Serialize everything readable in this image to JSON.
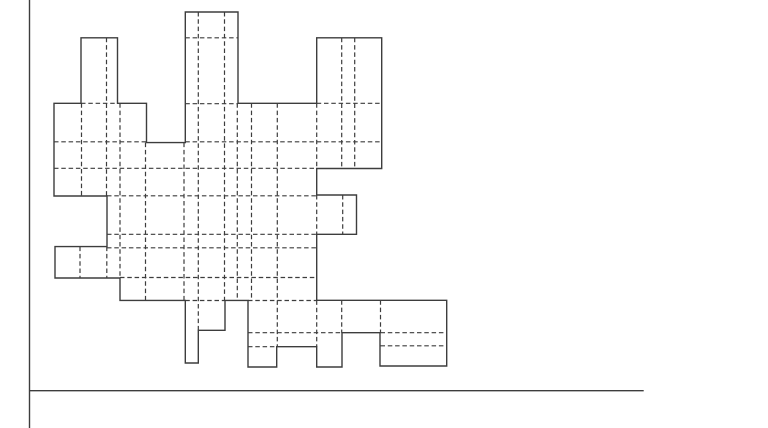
{
  "figure": {
    "canvas": {
      "width": 768,
      "height": 428,
      "background": "#ffffff"
    },
    "style": {
      "line_color": "#3d3d3d",
      "outline_width": 1.4,
      "dashed_width": 1.2,
      "spine_width": 1.4,
      "dash_pattern": "4.5 2.8"
    },
    "axes": {
      "y_spine": {
        "x": 29.5,
        "y1": 0,
        "y2": 428
      },
      "x_spine": {
        "y": 390.7,
        "x1": 29.5,
        "x2": 643.7
      }
    },
    "outline_polygon": [
      [
        81,
        37.8
      ],
      [
        117.5,
        37.8
      ],
      [
        117.5,
        103.3
      ],
      [
        146.5,
        103.3
      ],
      [
        146.5,
        142.6
      ],
      [
        185.3,
        142.6
      ],
      [
        185.3,
        12
      ],
      [
        238,
        12
      ],
      [
        238,
        103.3
      ],
      [
        316.7,
        103.3
      ],
      [
        316.7,
        37.8
      ],
      [
        381.7,
        37.8
      ],
      [
        381.7,
        168.5
      ],
      [
        316.7,
        168.5
      ],
      [
        316.7,
        195
      ],
      [
        356.5,
        195
      ],
      [
        356.5,
        234.3
      ],
      [
        316.7,
        234.3
      ],
      [
        316.7,
        300.3
      ],
      [
        446.7,
        300.3
      ],
      [
        446.7,
        366
      ],
      [
        380,
        366
      ],
      [
        380,
        332.7
      ],
      [
        342,
        332.7
      ],
      [
        342,
        367
      ],
      [
        316.7,
        367
      ],
      [
        316.7,
        346.7
      ],
      [
        276.7,
        346.7
      ],
      [
        276.7,
        367
      ],
      [
        248,
        367
      ],
      [
        248,
        300.4
      ],
      [
        225,
        300.4
      ],
      [
        225,
        330.3
      ],
      [
        198.3,
        330.3
      ],
      [
        198.3,
        363
      ],
      [
        185.3,
        363
      ],
      [
        185.3,
        300.4
      ],
      [
        120,
        300.4
      ],
      [
        120,
        278
      ],
      [
        55,
        278
      ],
      [
        55,
        246.6
      ],
      [
        107,
        246.6
      ],
      [
        107,
        196
      ],
      [
        54,
        196
      ],
      [
        54,
        103.3
      ],
      [
        81,
        103.3
      ]
    ],
    "dashed_vertical": [
      {
        "x": 106.5,
        "y1": 37.8,
        "y2": 196
      },
      {
        "x": 106.8,
        "y1": 246.6,
        "y2": 278
      },
      {
        "x": 81.5,
        "y1": 103.3,
        "y2": 196
      },
      {
        "x": 80,
        "y1": 246.6,
        "y2": 278
      },
      {
        "x": 120,
        "y1": 103.3,
        "y2": 278
      },
      {
        "x": 145.5,
        "y1": 142.6,
        "y2": 300.4
      },
      {
        "x": 184,
        "y1": 142.6,
        "y2": 300.4
      },
      {
        "x": 198.3,
        "y1": 12,
        "y2": 330.3
      },
      {
        "x": 224.5,
        "y1": 12,
        "y2": 300.4
      },
      {
        "x": 237.3,
        "y1": 103.3,
        "y2": 300.4
      },
      {
        "x": 251.5,
        "y1": 103.3,
        "y2": 300.4
      },
      {
        "x": 277.3,
        "y1": 103.3,
        "y2": 346.7
      },
      {
        "x": 316.7,
        "y1": 103.3,
        "y2": 168.5
      },
      {
        "x": 316.7,
        "y1": 195,
        "y2": 234.3
      },
      {
        "x": 316.7,
        "y1": 300.4,
        "y2": 346.7
      },
      {
        "x": 341.7,
        "y1": 37.8,
        "y2": 168.5
      },
      {
        "x": 342.7,
        "y1": 195,
        "y2": 234.3
      },
      {
        "x": 341.7,
        "y1": 300.3,
        "y2": 332.7
      },
      {
        "x": 354.7,
        "y1": 37.8,
        "y2": 168.5
      },
      {
        "x": 380.5,
        "y1": 300.3,
        "y2": 332.7
      }
    ],
    "dashed_horizontal": [
      {
        "y": 37.8,
        "x1": 185.3,
        "x2": 238
      },
      {
        "y": 103.3,
        "x1": 81,
        "x2": 117.5
      },
      {
        "y": 103.7,
        "x1": 185.3,
        "x2": 238
      },
      {
        "y": 103.3,
        "x1": 316.7,
        "x2": 381.7
      },
      {
        "y": 141.8,
        "x1": 54,
        "x2": 146.5
      },
      {
        "y": 141.8,
        "x1": 185.3,
        "x2": 381.7
      },
      {
        "y": 168.3,
        "x1": 54,
        "x2": 316.7
      },
      {
        "y": 195.8,
        "x1": 107,
        "x2": 316.7
      },
      {
        "y": 234.3,
        "x1": 107,
        "x2": 316.7
      },
      {
        "y": 247.8,
        "x1": 107,
        "x2": 316.7
      },
      {
        "y": 277.5,
        "x1": 120,
        "x2": 316.7
      },
      {
        "y": 300.5,
        "x1": 185.3,
        "x2": 225
      },
      {
        "y": 300.5,
        "x1": 248,
        "x2": 316.7
      },
      {
        "y": 332.7,
        "x1": 248,
        "x2": 342
      },
      {
        "y": 332.7,
        "x1": 380.5,
        "x2": 446.7
      },
      {
        "y": 345.8,
        "x1": 380.5,
        "x2": 446.7
      },
      {
        "y": 346.7,
        "x1": 248,
        "x2": 276.7
      }
    ]
  }
}
